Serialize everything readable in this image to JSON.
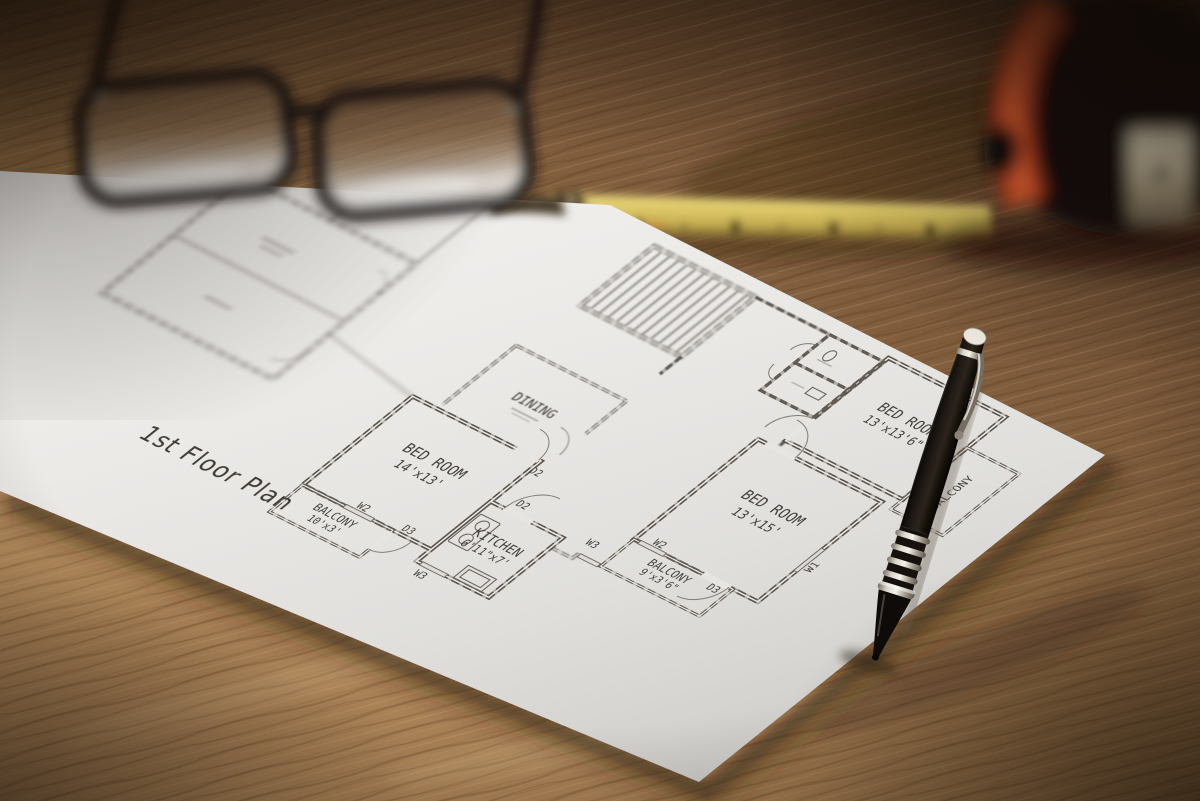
{
  "floor_plan": {
    "title": "1st Floor Plan",
    "rooms": {
      "bedroom_left": {
        "name": "BED ROOM",
        "dims": "14'x13'"
      },
      "balcony_left": {
        "name": "BALCONY",
        "dims": "10'x3'"
      },
      "kitchen": {
        "name": "KITCHEN",
        "dims": "6'11\"x7'"
      },
      "bedroom_right": {
        "name": "BED ROOM",
        "dims": "13'x15'"
      },
      "balcony_right": {
        "name": "BALCONY",
        "dims": "9'x3'6\""
      },
      "bedroom_top": {
        "name": "BED ROOM",
        "dims": "13'x13'6\""
      },
      "dining": {
        "name": "DINING",
        "dims": ""
      },
      "balcony_edge": {
        "name": "BALCONY",
        "dims": ""
      }
    },
    "wall_labels": {
      "d2": "D2",
      "d3": "D3",
      "w1": "W1",
      "w2": "W2",
      "w3": "W3"
    }
  },
  "objects": {
    "glasses": "black-frame eyeglasses",
    "ruler": "yellow folding ruler",
    "tape_measure": "tape measure",
    "pen": "black pen",
    "paper": "floor plan sheet",
    "table": "wooden table"
  },
  "colors": {
    "wood": "#a67c52",
    "paper": "#e9e8e6",
    "ink": "#55504c",
    "ruler_yellow": "#d6c05f",
    "tape_red": "#d8522c",
    "pen_black": "#17110d"
  }
}
